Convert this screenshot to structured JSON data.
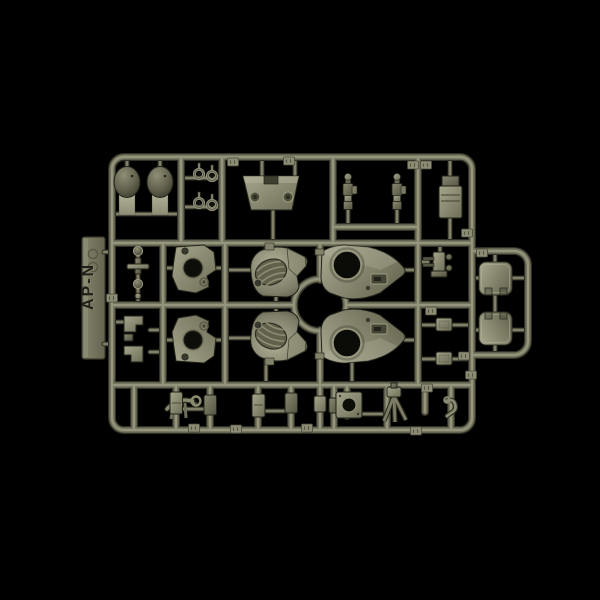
{
  "sprue": {
    "tab_label": "AP-N",
    "background_color": "#000000",
    "plastic_colors": {
      "highlight": "#9b9b82",
      "mid": "#73735e",
      "shadow": "#303026",
      "part_light": "#a6a68c",
      "part_dark": "#55554a"
    },
    "parts": [
      {
        "name": "dome-shell",
        "count": 2
      },
      {
        "name": "c-clip",
        "count": 4
      },
      {
        "name": "trapezoid-plate",
        "count": 1
      },
      {
        "name": "suspension-assembly",
        "count": 2
      },
      {
        "name": "canister",
        "count": 1
      },
      {
        "name": "plate-with-holes",
        "count": 2
      },
      {
        "name": "turret-shell-half",
        "count": 2
      },
      {
        "name": "hull-half",
        "count": 2
      },
      {
        "name": "gun-mount",
        "count": 1
      },
      {
        "name": "hatch-cover",
        "count": 2
      },
      {
        "name": "bracket",
        "count": 2
      },
      {
        "name": "square-plate-with-hole",
        "count": 1
      },
      {
        "name": "tripod",
        "count": 1
      },
      {
        "name": "tow-hook",
        "count": 1
      },
      {
        "name": "small-block",
        "count": 8
      }
    ]
  }
}
